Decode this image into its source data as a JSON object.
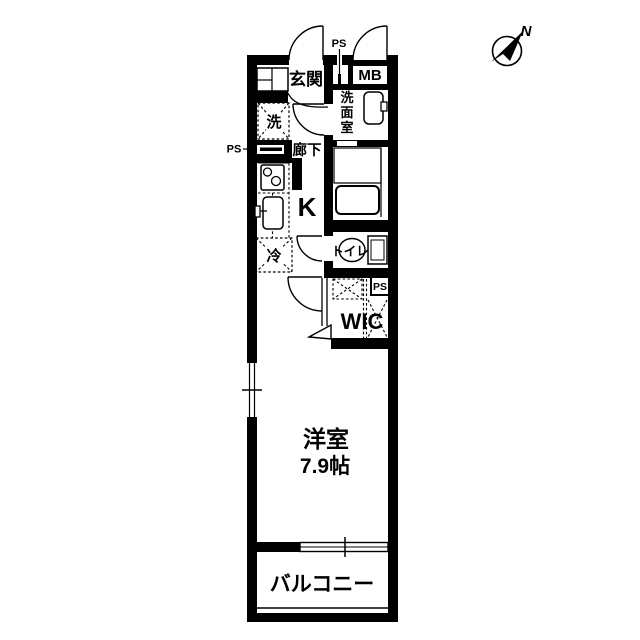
{
  "plan": {
    "type": "apartment-floor-plan",
    "compass": {
      "north_label": "N"
    },
    "rooms": {
      "genkan": {
        "label": "玄関"
      },
      "senmenshitsu": {
        "label": "洗面室",
        "chars": [
          "洗",
          "面",
          "室"
        ]
      },
      "rouka": {
        "label": "廊下"
      },
      "kitchen": {
        "label": "K"
      },
      "toilet": {
        "label": "トイレ"
      },
      "wic": {
        "label": "WIC"
      },
      "bedroom": {
        "label": "洋室",
        "size": "7.9帖"
      },
      "balcony": {
        "label": "バルコニー"
      }
    },
    "fixtures": {
      "meter_box": {
        "label": "MB"
      },
      "washer": {
        "label": "洗"
      },
      "fridge": {
        "label": "冷"
      },
      "ps_top": {
        "label": "PS"
      },
      "ps_left": {
        "label": "PS"
      },
      "ps_wic": {
        "label": "PS"
      }
    },
    "colors": {
      "wall": "#000000",
      "background": "#ffffff"
    }
  }
}
